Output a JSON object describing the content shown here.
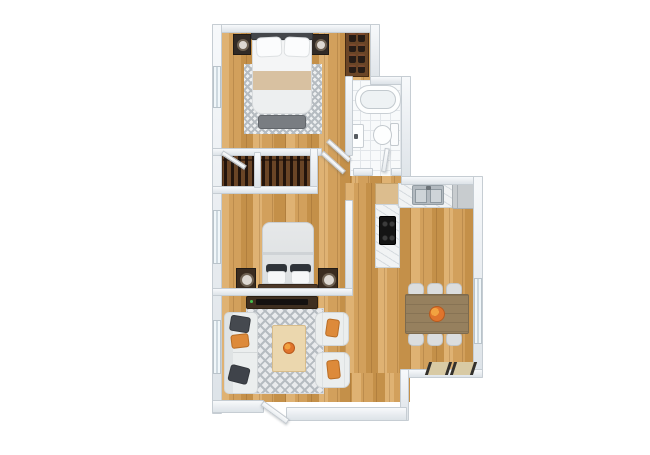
{
  "scene": {
    "type": "3d-floor-plan-render",
    "title": "Two-bedroom apartment 3D floor plan, top-down view",
    "background": "#ffffff",
    "text_visible": "none"
  },
  "palette": {
    "wall": "#e7ebef",
    "wallEdge": "#c6cdd3",
    "wood": "#d2a05c",
    "woodLight": "#dfb273",
    "woodDark": "#c49049",
    "tile": "#f8fafb",
    "tileLine": "#e2e6ea",
    "rug": "#b6bcc1",
    "closetWood": "#6a4526",
    "accent": "#dd8a3a",
    "steel": "#b3bac0",
    "cooktop": "#141414",
    "tableWood": "#96805e",
    "consoleWood": "#3f2f20"
  },
  "rooms": [
    {
      "id": "bedroom-1",
      "position": "top-left",
      "furniture": [
        "double bed with beige throw",
        "two dark nightstands with lamps",
        "gray foot bench",
        "checkered area rug",
        "shoe shelf in niche"
      ]
    },
    {
      "id": "bathroom",
      "position": "top-right",
      "furniture": [
        "bathtub",
        "wall sink",
        "toilet"
      ]
    },
    {
      "id": "hallway",
      "position": "center",
      "furniture": [
        "two open closets with hanging clothes"
      ]
    },
    {
      "id": "bedroom-2",
      "position": "middle-left",
      "furniture": [
        "double bed with dark pillows",
        "two dark nightstands with round lamps"
      ]
    },
    {
      "id": "kitchen",
      "position": "middle-right",
      "furniture": [
        "L-shaped counter",
        "double stainless sink",
        "black cooktop",
        "fridge cabinet",
        "cutting-board counter"
      ]
    },
    {
      "id": "dining-area",
      "position": "bottom-right",
      "furniture": [
        "wooden table",
        "six light chairs",
        "orange centerpiece",
        "floor mats at window"
      ]
    },
    {
      "id": "living-room",
      "position": "bottom-left",
      "furniture": [
        "white sofa with dark and orange pillows",
        "light wood coffee table with orange bowl",
        "two white armchairs with orange pillows",
        "dark TV console",
        "diamond-pattern rug",
        "entry door"
      ]
    }
  ],
  "door_count": 5,
  "window_count": 4
}
